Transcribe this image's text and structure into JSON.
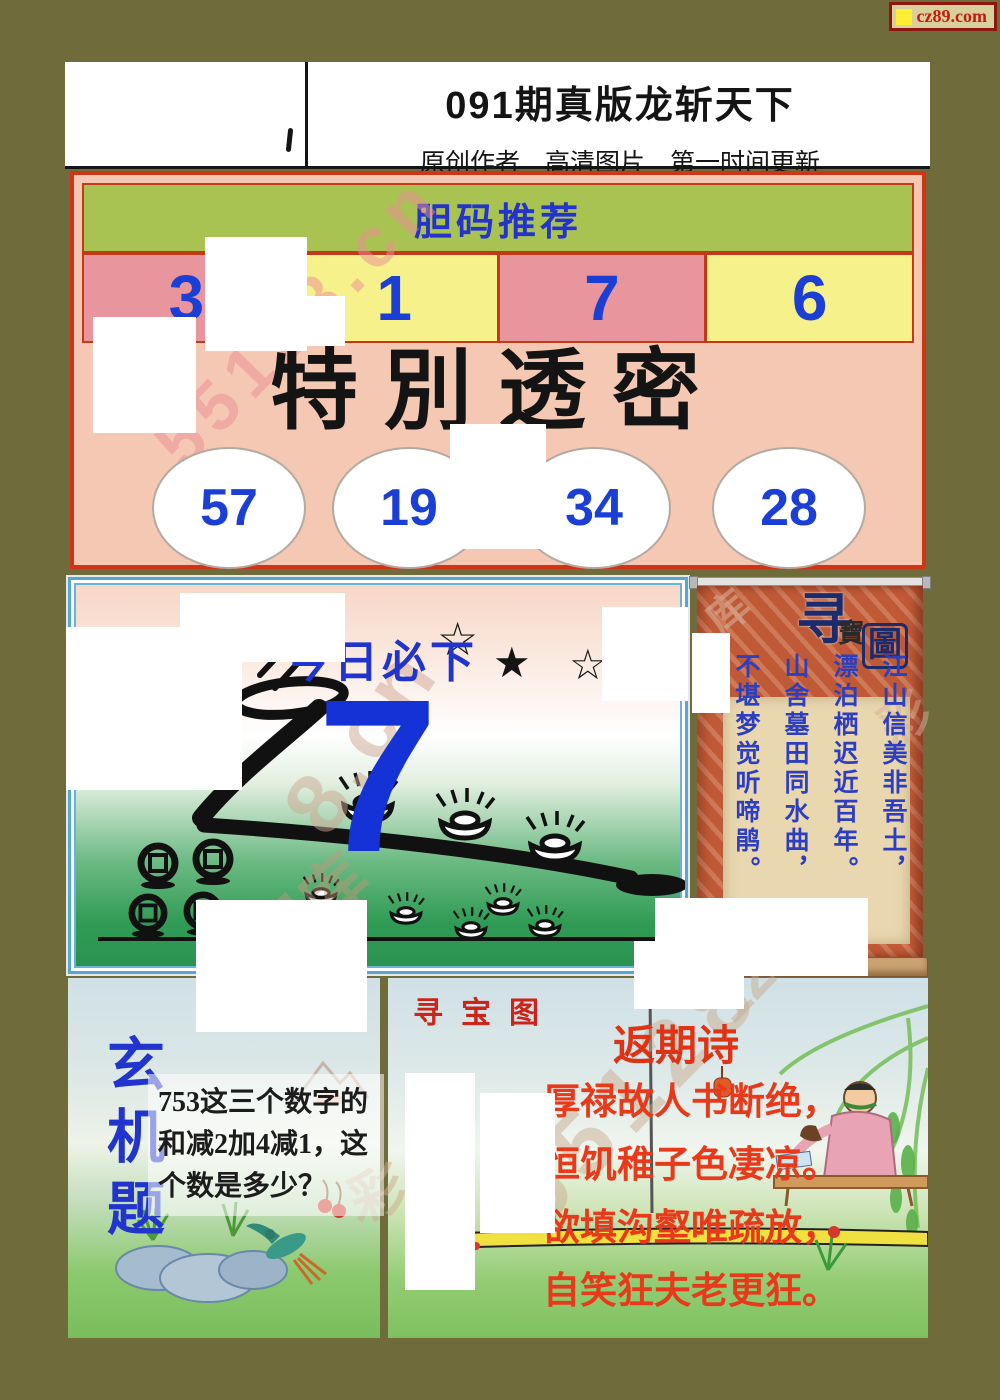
{
  "badge": {
    "label": "cz89.com"
  },
  "header": {
    "title": "091期真版龙斩天下",
    "subtitle": "原创作者　高清图片　第一时间更新"
  },
  "danma": {
    "title": "胆码推荐",
    "numbers": [
      "3",
      "1",
      "7",
      "6"
    ]
  },
  "toumi": {
    "title": "特別透密",
    "numbers": [
      "57",
      "19",
      "34",
      "28"
    ]
  },
  "today": {
    "label": "今日必下",
    "number": "7",
    "stars": [
      "☆",
      "★",
      "☆"
    ]
  },
  "scroll": {
    "title_big": "寻",
    "title_small": "寶",
    "title_boxed": "圖",
    "poem_columns": [
      "江山信美非吾土，",
      "漂泊栖迟近百年。",
      "山舍墓田同水曲，",
      "不堪梦觉听啼鹃。"
    ]
  },
  "xuanji": {
    "title": "玄机题",
    "question": "753这三个数字的和减2加4减1，这个数是多少？"
  },
  "xunbao": {
    "title": "寻宝图",
    "poem_title": "返期诗",
    "poem_lines": [
      "厚禄故人书断绝，",
      "恒饥稚子色凄凉。",
      "欲填沟壑唯疏放，",
      "自笑狂夫老更狂。"
    ]
  },
  "watermarks": [
    {
      "text": "55128.cn"
    },
    {
      "text": "8.cn"
    },
    {
      "text": "图库"
    },
    {
      "text": "55128"
    },
    {
      "text": "128."
    },
    {
      "text": "库"
    },
    {
      "text": "彩"
    },
    {
      "text": "彩"
    }
  ],
  "colors": {
    "olive_bg": "#6f6b3a",
    "accent_blue": "#1b3fd4",
    "accent_red": "#e8391a",
    "border_red": "#cf3516",
    "bar_green": "#a9c352",
    "cell_pink": "#e9959e",
    "cell_yellow": "#f7f18c",
    "section_salmon": "#f4c8b2",
    "scroll_orange": "#c05a36"
  }
}
